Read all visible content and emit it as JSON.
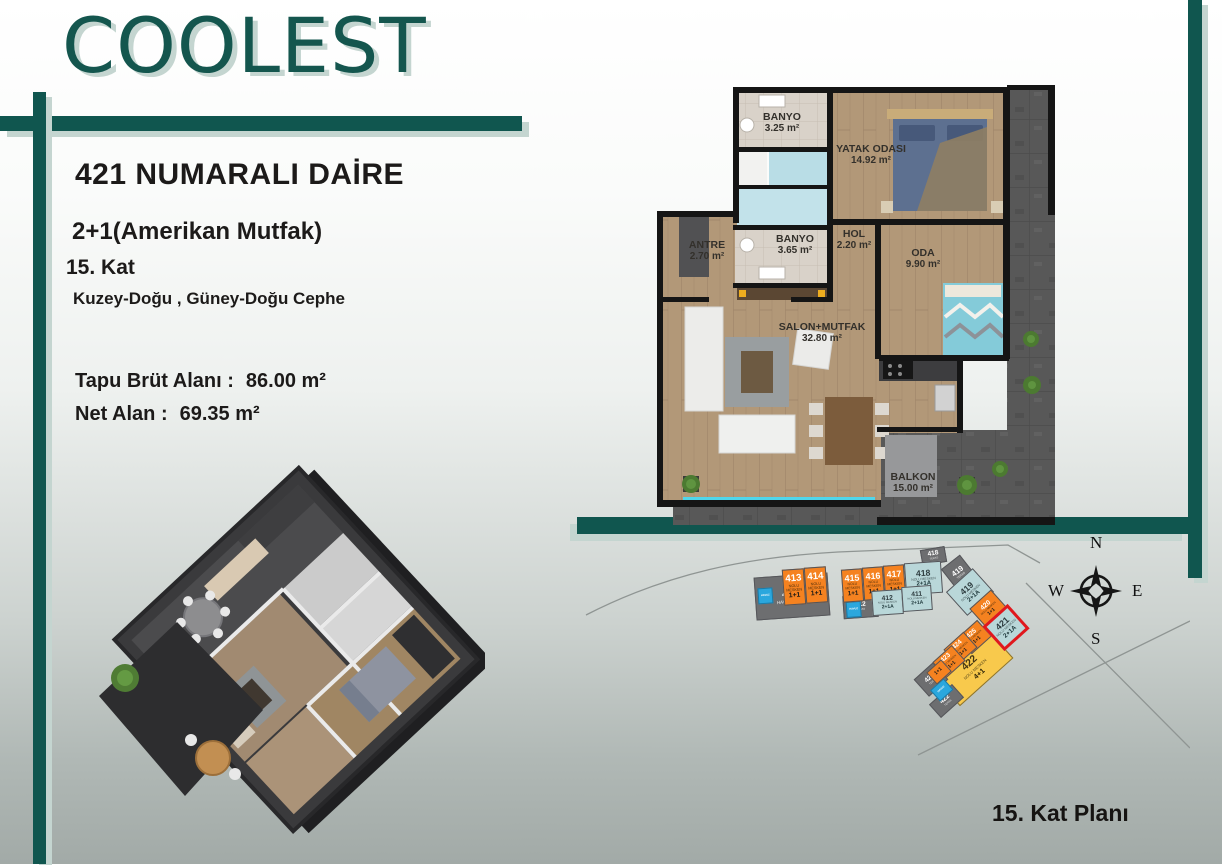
{
  "brand": {
    "logo": "COOLEST"
  },
  "apartment": {
    "title": "421 NUMARALI DAİRE",
    "layout_type": "2+1(Amerikan Mutfak)",
    "floor": "15. Kat",
    "facade": "Kuzey-Doğu , Güney-Doğu Cephe",
    "gross_area_label": "Tapu Brüt Alanı :",
    "gross_area_value": "86.00 m²",
    "net_area_label": "Net Alan :",
    "net_area_value": "69.35 m²"
  },
  "floor_plan": {
    "rooms": [
      {
        "name": "BANYO",
        "area": "3.25 m²",
        "x": 127,
        "y": 38
      },
      {
        "name": "YATAK ODASI",
        "area": "14.92 m²",
        "x": 216,
        "y": 70
      },
      {
        "name": "ANTRE",
        "area": "2.70 m²",
        "x": 52,
        "y": 166
      },
      {
        "name": "BANYO",
        "area": "3.65 m²",
        "x": 140,
        "y": 160
      },
      {
        "name": "HOL",
        "area": "2.20 m²",
        "x": 199,
        "y": 155
      },
      {
        "name": "ODA",
        "area": "9.90 m²",
        "x": 268,
        "y": 174
      },
      {
        "name": "SALON+MUTFAK",
        "area": "32.80 m²",
        "x": 167,
        "y": 248
      },
      {
        "name": "BALKON",
        "area": "15.00 m²",
        "x": 258,
        "y": 398
      }
    ]
  },
  "site_plan": {
    "caption": "15. Kat Planı",
    "compass": {
      "n": "N",
      "s": "S",
      "e": "E",
      "w": "W"
    },
    "blocks": [
      {
        "id": "teras-413",
        "number": "413",
        "sub": "HAVUZ TERAS",
        "type": "",
        "color": "gray",
        "x": 177,
        "y": 32,
        "w": 74,
        "h": 43,
        "rot": -4,
        "pool": "left",
        "z": 1
      },
      {
        "id": "mesken-413",
        "number": "413",
        "sub": "NOLU MESKEN",
        "type": "1+1",
        "color": "orange",
        "x": 205,
        "y": 26,
        "w": 22,
        "h": 36,
        "rot": -4,
        "z": 2
      },
      {
        "id": "mesken-414",
        "number": "414",
        "sub": "NOLU MESKEN",
        "type": "1+1",
        "color": "orange",
        "x": 227,
        "y": 24,
        "w": 22,
        "h": 36,
        "rot": -4,
        "z": 2
      },
      {
        "id": "mesken-415",
        "number": "415",
        "sub": "NOLU MESKEN",
        "type": "1+1",
        "color": "orange",
        "x": 264,
        "y": 26,
        "w": 21,
        "h": 33,
        "rot": -4,
        "z": 2
      },
      {
        "id": "mesken-416",
        "number": "416",
        "sub": "NOLU MESKEN",
        "type": "1+1",
        "color": "orange",
        "x": 285,
        "y": 24,
        "w": 21,
        "h": 33,
        "rot": -4,
        "z": 2
      },
      {
        "id": "mesken-417",
        "number": "417",
        "sub": "NOLU MESKEN",
        "type": "1+1",
        "color": "orange",
        "x": 306,
        "y": 22,
        "w": 21,
        "h": 33,
        "rot": -4,
        "z": 2
      },
      {
        "id": "mesken-418",
        "number": "418",
        "sub": "NOLU MESKEN",
        "type": "2+1A",
        "color": "blue",
        "x": 327,
        "y": 19,
        "w": 37,
        "h": 32,
        "rot": -4,
        "z": 2
      },
      {
        "id": "teras-418",
        "number": "418",
        "sub": "TERAS",
        "type": "",
        "color": "gray",
        "x": 343,
        "y": 5,
        "w": 25,
        "h": 16,
        "rot": -10,
        "z": 1
      },
      {
        "id": "teras-419",
        "number": "419",
        "sub": "TERAS",
        "type": "",
        "color": "gray",
        "x": 369,
        "y": 16,
        "w": 24,
        "h": 28,
        "rot": -38,
        "z": 1
      },
      {
        "id": "teras-412",
        "number": "412",
        "sub": "TERAS",
        "type": "",
        "color": "gray",
        "x": 265,
        "y": 52,
        "w": 35,
        "h": 23,
        "rot": -4,
        "pool": "left",
        "z": 1
      },
      {
        "id": "mesken-412",
        "number": "412",
        "sub": "NOLU MESKEN",
        "type": "2+1A",
        "color": "blue",
        "x": 294,
        "y": 47,
        "w": 31,
        "h": 25,
        "rot": -4,
        "z": 2
      },
      {
        "id": "mesken-411",
        "number": "411",
        "sub": "NOLU MESKEN",
        "type": "2+1A",
        "color": "blue",
        "x": 324,
        "y": 43,
        "w": 30,
        "h": 25,
        "rot": -4,
        "z": 2
      },
      {
        "id": "mesken-419",
        "number": "419",
        "sub": "NOLU MESKEN",
        "type": "2+1A",
        "color": "blue",
        "x": 374,
        "y": 33,
        "w": 36,
        "h": 32,
        "rot": -42,
        "z": 2
      },
      {
        "id": "mesken-420",
        "number": "420",
        "sub": "NOLU MESKEN",
        "type": "1+1",
        "color": "orange",
        "x": 396,
        "y": 53,
        "w": 29,
        "h": 25,
        "rot": -42,
        "z": 2
      },
      {
        "id": "mesken-421",
        "number": "421",
        "sub": "NOLU MESKEN",
        "type": "2+1A",
        "color": "blue",
        "x": 411,
        "y": 68,
        "w": 34,
        "h": 33,
        "rot": -42,
        "highlight": true,
        "z": 4
      },
      {
        "id": "mesken-425",
        "number": "425",
        "sub": "NOLU MESKEN",
        "type": "1+1",
        "color": "orange",
        "x": 383,
        "y": 83,
        "w": 27,
        "h": 22,
        "rot": -42,
        "z": 3
      },
      {
        "id": "mesken-424",
        "number": "424",
        "sub": "NOLU MESKEN",
        "type": "1+1",
        "color": "orange",
        "x": 369,
        "y": 95,
        "w": 27,
        "h": 21,
        "rot": -42,
        "z": 3
      },
      {
        "id": "mesken-423",
        "number": "423",
        "sub": "NOLU MESKEN",
        "type": "1+1",
        "color": "orange",
        "x": 358,
        "y": 108,
        "w": 26,
        "h": 21,
        "rot": -42,
        "z": 3
      },
      {
        "id": "mesken-423b",
        "number": "",
        "sub": "",
        "type": "1+1",
        "color": "orange",
        "x": 351,
        "y": 121,
        "w": 20,
        "h": 16,
        "rot": -42,
        "z": 3
      },
      {
        "id": "teras-423",
        "number": "423",
        "sub": "TERAS",
        "type": "",
        "color": "gray",
        "x": 340,
        "y": 125,
        "w": 26,
        "h": 23,
        "rot": -42,
        "pool": "bottom",
        "z": 2
      },
      {
        "id": "mesken-422",
        "number": "422",
        "sub": "NOLU MESKEN",
        "type": "4+1",
        "color": "yellow",
        "x": 360,
        "y": 106,
        "w": 72,
        "h": 38,
        "rot": -42,
        "z": 1
      },
      {
        "id": "teras-422",
        "number": "422",
        "sub": "TERAS",
        "type": "",
        "color": "gray",
        "x": 353,
        "y": 149,
        "w": 31,
        "h": 18,
        "rot": -42,
        "z": 1
      }
    ],
    "pool_label": "HAVUZ"
  },
  "colors": {
    "teal": "#10564f",
    "teal_shadow": "#c4d5d0",
    "orange": "#f58220",
    "unit_blue": "#b9d7d9",
    "unit_gray": "#6d6e70",
    "unit_yellow": "#f8c94c",
    "highlight_red": "#e0181d",
    "pool_blue": "#2ba7dd"
  }
}
